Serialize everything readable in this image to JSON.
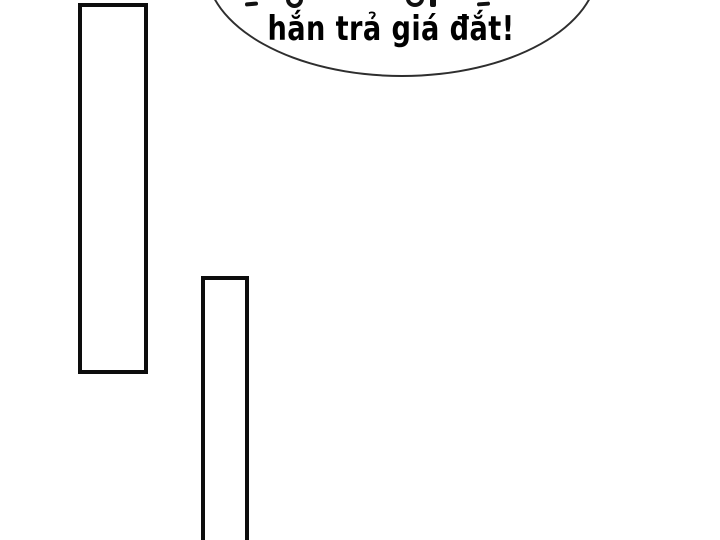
{
  "panel": {
    "background": "#ffffff",
    "ink_color": "#0d0d0d"
  },
  "speech_bubble": {
    "fill": "#ffffff",
    "stroke_color": "#2e2e2e",
    "text_color": "#000000",
    "line1_cropped": "…g …g p…",
    "line2": "hắn trả giá đắt!"
  },
  "shapes": {
    "left_frame": "tall-rectangle",
    "middle_frame": "tall-rectangle-cropped-at-bottom"
  }
}
